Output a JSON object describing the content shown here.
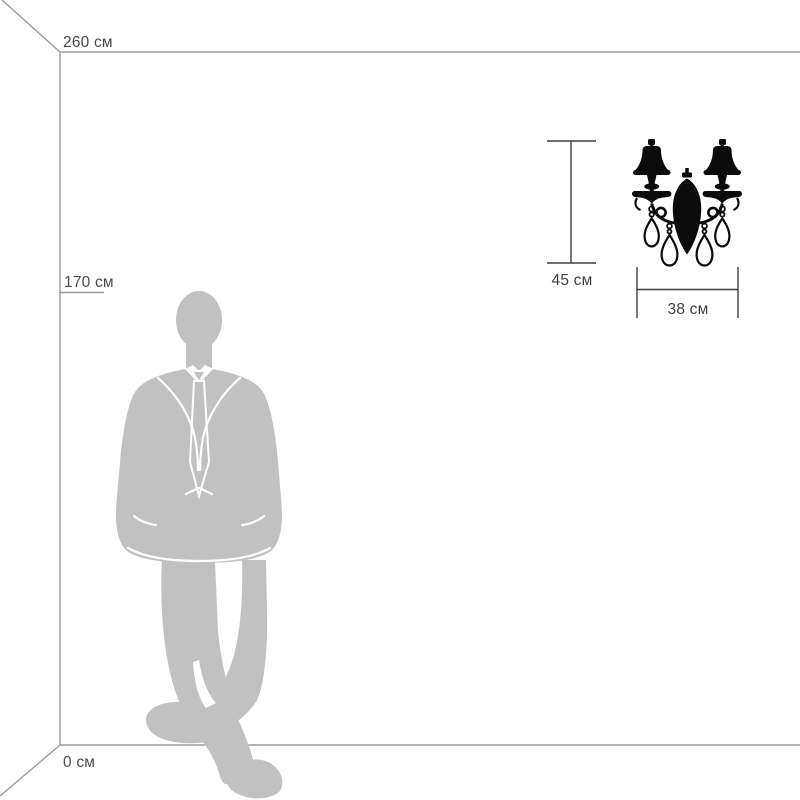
{
  "diagram": {
    "kind": "product-scale-diagram",
    "room": {
      "wall_height_label": "260 см",
      "person_height_label": "170 см",
      "floor_label": "0 см"
    },
    "product": {
      "name": "two-arm crystal wall sconce silhouette",
      "height_label": "45 см",
      "width_label": "38 см"
    },
    "person": {
      "name": "standing man silhouette, hands in pockets, legs crossed"
    }
  },
  "colors": {
    "background": "#ffffff",
    "wall_line": "#9b9b9b",
    "dimension_line": "#3f3f3f",
    "label_text": "#4a4a4a",
    "person_fill": "#c1c1c1",
    "detail_white": "#ffffff",
    "product_fill": "#0b0b0b",
    "crystal_fill": "#ffffff"
  }
}
